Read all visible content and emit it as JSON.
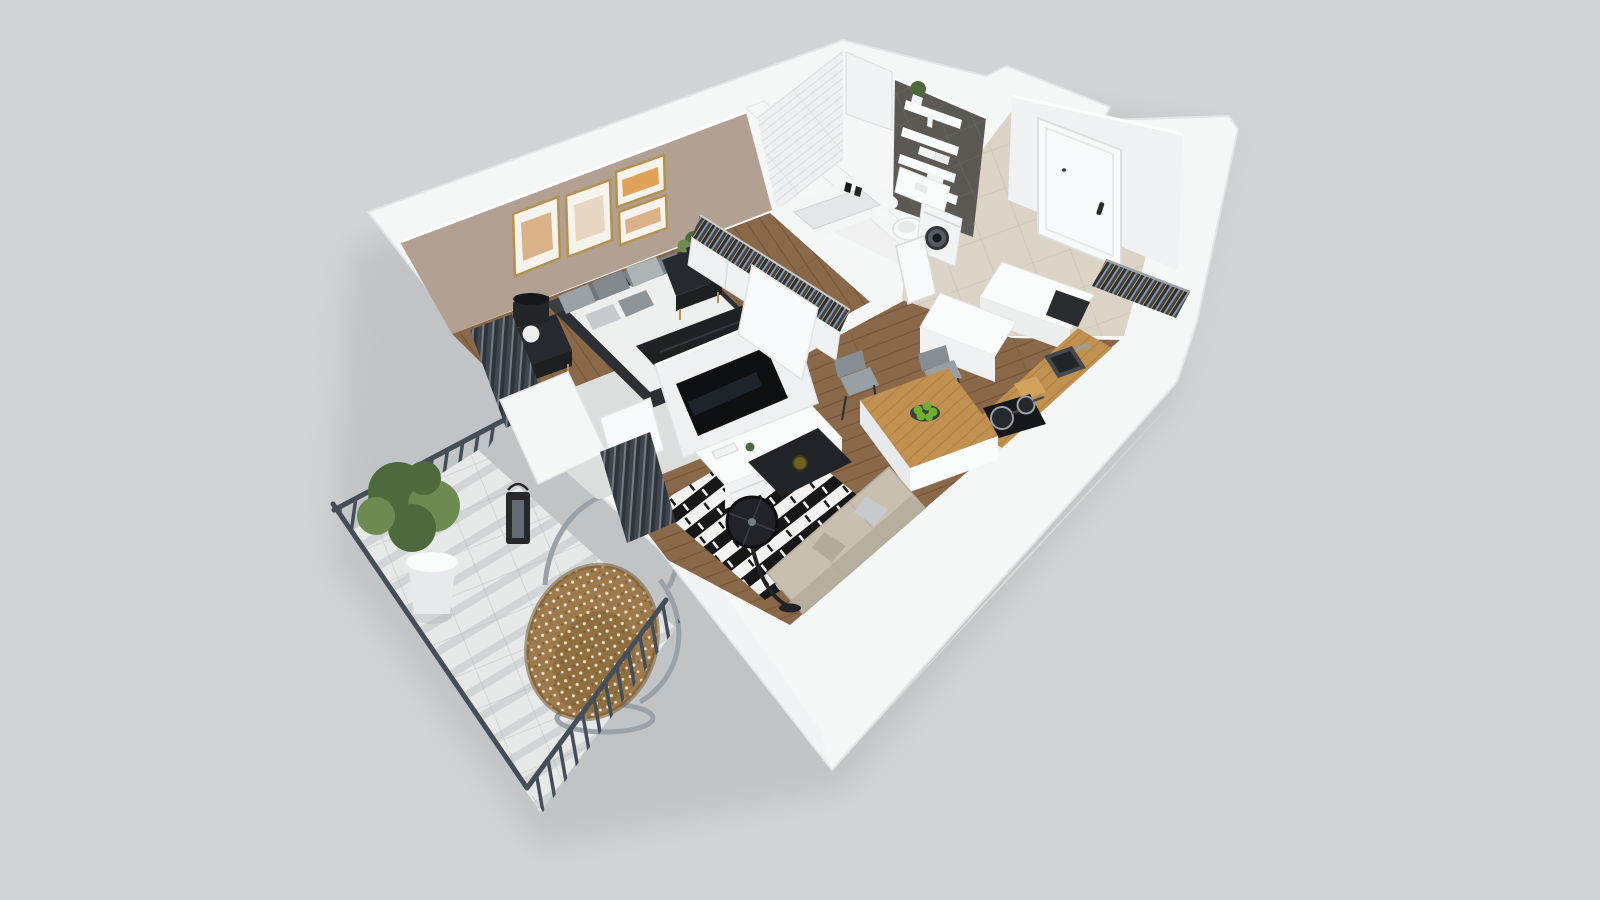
{
  "scene": {
    "description": "3D isometric rendering of a studio apartment floor plan with bedroom, bathroom, entry hall, kitchen, living room and balcony",
    "background": "#d2d3d4"
  },
  "palette": {
    "bg": "#d2d3d4",
    "buildingShadow": "#aab0b3",
    "wall": "#f5f6f6",
    "wallEdge": "#e2e4e5",
    "wallShade": "#ecEEee",
    "wallInner": "#eef0f1",
    "taupe": "#b2a093",
    "tileWhite": "#edeff1",
    "tileLine": "#d7dbde",
    "ductTile": "#f2f3f5",
    "darkWall": "#5c5955",
    "grout": "#6e6b66",
    "woodFloor": "#8a684a",
    "plankLine": "#775739",
    "beigeFloor": "#dbd4c6",
    "beigeLine": "#c9c2b4",
    "hallTileWhite": "#eff0ef",
    "balconyTile": "#e7e9e9",
    "balconyLine": "#cbcfcf",
    "balconyShadow": "#a9afb2",
    "railing": "#454e58",
    "white": "#fafbfb",
    "offWhite": "#f0f1f2",
    "grayPanel": "#e7e9ea",
    "doorWhite": "#f8f9fa",
    "handleBlack": "#2a2d30",
    "metalGray": "#9aa1a7",
    "charcoal": "#232629",
    "black": "#15171a",
    "tvScreen": "#0e1013",
    "tvGlare": "#2b323a",
    "lampDark": "#202327",
    "sofa": "#c8bfb1",
    "sofaShade": "#b3aa9b",
    "rugBlack": "#171717",
    "rugWhite": "#f2f2f1",
    "rugLightBedroom": "#dcdedd",
    "counterWood": "#c09150",
    "counterLine": "#a87c3e",
    "boardTan": "#d2a35e",
    "sinkDark": "#45494d",
    "rattan": "#9c7a4b",
    "rattanShade": "#77592f",
    "rattanDot": "#f1e8d6",
    "plantGreen": "#4e6a3c",
    "plantLight": "#6c8a52",
    "apple": "#6fae2e",
    "applePlate": "#3a3d40",
    "gold": "#b3914f",
    "mattress": "#edefef",
    "bedFrame": "#2c2f33",
    "headboard": "#3a3e43",
    "throw": "#1f2225",
    "nightstand": "#26292d",
    "nightstandFront": "#1d2023",
    "pillow1": "#9aa0a3",
    "pillow2": "#82888c",
    "pillow3": "#aeb3b6",
    "pillow4": "#c6cacc",
    "pillow5": "#8e9397",
    "cushionA": "#6e7477",
    "cushionB": "#7c8285",
    "artWarm": "#d9b28a",
    "artOrange": "#e0a259",
    "artPale": "#e6d6c2",
    "frameMat": "#f6f3ec",
    "curtain": "#3f464d",
    "curtainLight": "#737b84",
    "curtainDark": "#2f353b",
    "lanternDark": "#26292c",
    "chairGray": "#99a0a5",
    "chairBack": "#878e93",
    "chairLeg": "#2b2e31",
    "towel": "#f2f3f4",
    "shelf": "#fafbfb",
    "washerDoor": "#2f343a",
    "hangerDark": "#2c3138",
    "hangerGray": "#8a929c",
    "hangerDenim": "#3d4550",
    "hangerWood": "#c49a5f",
    "vaseOlive": "#6e6326"
  },
  "rooms": [
    {
      "id": "bedroom",
      "label": "Bedroom",
      "items": [
        "double bed",
        "gray pillows",
        "wall art frames",
        "nightstands",
        "table lamp",
        "wardrobe with hanging clothes",
        "area rug",
        "curtains"
      ]
    },
    {
      "id": "bathroom",
      "label": "Bathroom",
      "items": [
        "bathtub",
        "toilet",
        "washing machine",
        "wall shelves",
        "towels",
        "plant"
      ]
    },
    {
      "id": "entry",
      "label": "Entry hallway",
      "items": [
        "front door",
        "coat rack",
        "shoe cabinet"
      ]
    },
    {
      "id": "kitchen",
      "label": "Kitchen",
      "items": [
        "counter with sink",
        "cooktop with pans",
        "cutting board",
        "island",
        "bar chairs",
        "plate of apples",
        "tall cabinet"
      ]
    },
    {
      "id": "living-room",
      "label": "Living room",
      "items": [
        "tv partition",
        "tv",
        "tv cabinet",
        "striped rug",
        "coffee table",
        "floor lamp",
        "sofa"
      ]
    },
    {
      "id": "balcony",
      "label": "Balcony",
      "items": [
        "metal railing",
        "tile floor",
        "potted plant",
        "hanging egg chair",
        "lantern"
      ]
    }
  ]
}
